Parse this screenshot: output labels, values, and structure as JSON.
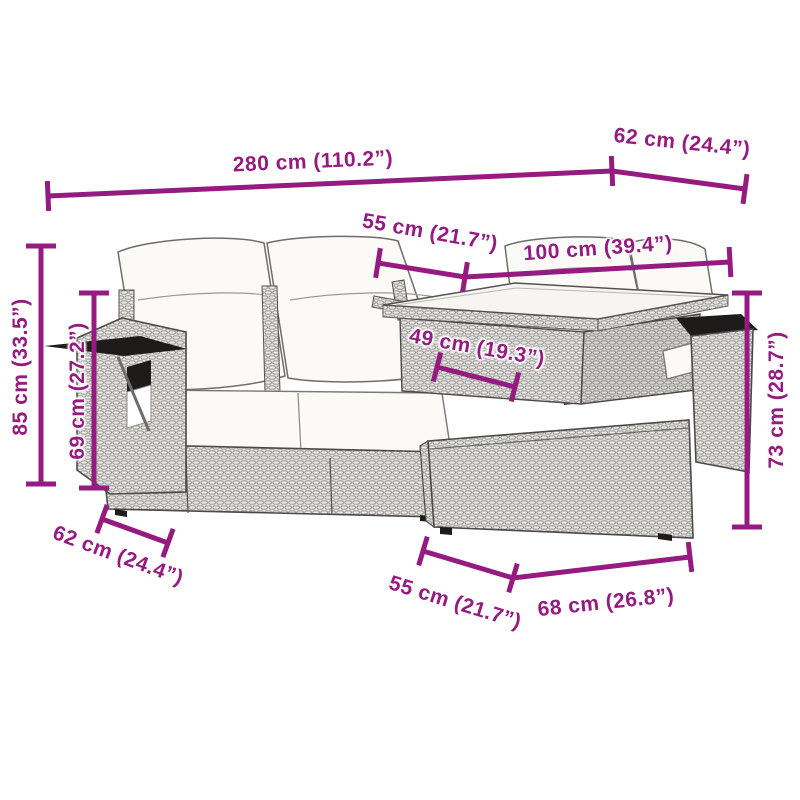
{
  "figure": {
    "type": "product-dimension-diagram",
    "subject": "5 piece poly rattan garden lounge set with cushions (sofa, corner bench, glass-top table, ottoman, armrest chair)"
  },
  "colors": {
    "annotation": "#951B81",
    "background": "#ffffff",
    "rattan_base": "#efedea",
    "rattan_line": "#8f8d8a",
    "outline": "#4a4a48",
    "dark_accent": "#1d1c1a",
    "cushion": "#fbfaf6"
  },
  "furniture_parts": [
    "back-pillows",
    "seat-cushions",
    "sofa-base",
    "left-armrest",
    "corner-bench",
    "glass-table-top",
    "table-skirt",
    "ottoman",
    "right-armrest"
  ],
  "dimensions": [
    {
      "id": "overall-width",
      "label": "280 cm (110.2”)",
      "line": {
        "x1": 48,
        "y1": 196,
        "x2": 612,
        "y2": 171
      },
      "ticks": "both",
      "text": {
        "x": 313,
        "y": 162,
        "rotation": -2.5
      }
    },
    {
      "id": "top-depth",
      "label": "62 cm (24.4”)",
      "line": {
        "x1": 612,
        "y1": 171,
        "x2": 745,
        "y2": 189
      },
      "ticks": "end",
      "text": {
        "x": 682,
        "y": 143,
        "rotation": 6
      }
    },
    {
      "id": "seat-width",
      "label": "55 cm (21.7”)",
      "line": {
        "x1": 378,
        "y1": 263,
        "x2": 465,
        "y2": 277
      },
      "ticks": "both",
      "text": {
        "x": 430,
        "y": 233,
        "rotation": 10
      }
    },
    {
      "id": "bench-width",
      "label": "100 cm (39.4”)",
      "line": {
        "x1": 465,
        "y1": 277,
        "x2": 730,
        "y2": 262
      },
      "ticks": "end",
      "text": {
        "x": 598,
        "y": 249,
        "rotation": -4
      }
    },
    {
      "id": "table-width",
      "label": "49 cm (19.3”)",
      "line": {
        "x1": 437,
        "y1": 367,
        "x2": 515,
        "y2": 387
      },
      "ticks": "both",
      "text": {
        "x": 477,
        "y": 348,
        "rotation": 10
      }
    },
    {
      "id": "back-height",
      "label": "85 cm (33.5”)",
      "line": {
        "x1": 41,
        "y1": 246,
        "x2": 41,
        "y2": 484
      },
      "ticks": "both",
      "text": {
        "x": 21,
        "y": 367,
        "rotation": -90
      }
    },
    {
      "id": "arm-height",
      "label": "69 cm (27.2”)",
      "line": {
        "x1": 94,
        "y1": 293,
        "x2": 94,
        "y2": 488
      },
      "ticks": "both",
      "text": {
        "x": 78,
        "y": 391,
        "rotation": -90
      }
    },
    {
      "id": "table-height",
      "label": "73 cm (28.7”)",
      "line": {
        "x1": 747,
        "y1": 293,
        "x2": 747,
        "y2": 527
      },
      "ticks": "both",
      "text": {
        "x": 777,
        "y": 400,
        "rotation": -90
      }
    },
    {
      "id": "seat-depth",
      "label": "62 cm (24.4”)",
      "line": {
        "x1": 102,
        "y1": 519,
        "x2": 168,
        "y2": 543
      },
      "ticks": "both",
      "text": {
        "x": 118,
        "y": 556,
        "rotation": 20
      }
    },
    {
      "id": "ottoman-depth",
      "label": "55 cm (21.7”)",
      "line": {
        "x1": 423,
        "y1": 551,
        "x2": 513,
        "y2": 578
      },
      "ticks": "both",
      "text": {
        "x": 455,
        "y": 603,
        "rotation": 17
      }
    },
    {
      "id": "ottoman-width",
      "label": "68 cm (26.8”)",
      "line": {
        "x1": 513,
        "y1": 578,
        "x2": 690,
        "y2": 557
      },
      "ticks": "end",
      "text": {
        "x": 606,
        "y": 603,
        "rotation": -6
      }
    }
  ]
}
